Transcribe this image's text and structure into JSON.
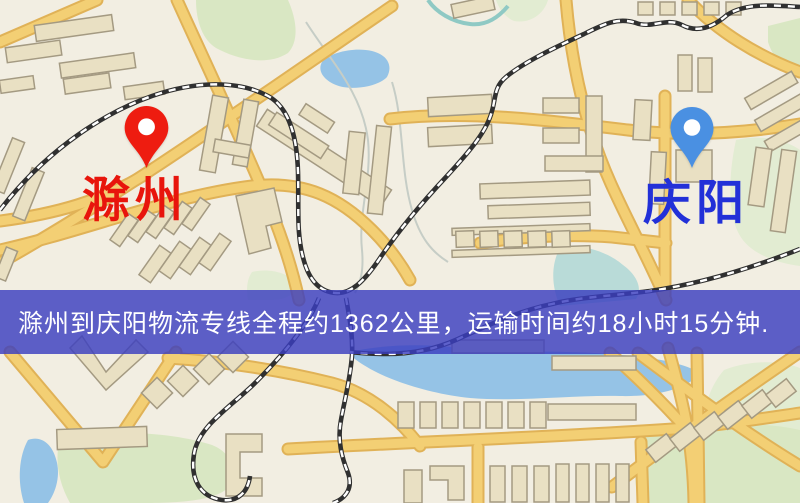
{
  "banner": {
    "text": "滁州到庆阳物流专线全程约1362公里，运输时间约18小时15分钟.",
    "background": "rgba(58,62,192,0.82)",
    "text_color": "#ffffff"
  },
  "markers": {
    "origin": {
      "label": "滁州",
      "pin_color": "#ee1c10",
      "label_color": "#e8150c"
    },
    "destination": {
      "label": "庆阳",
      "pin_color": "#4a90e2",
      "label_color": "#2230d8"
    }
  },
  "palette": {
    "base": "#f2eee2",
    "road": "#f3cf74",
    "road_casing": "#e0b257",
    "building": "#e9e0c3",
    "building_border": "#a49a82",
    "water": "#95c3e6",
    "park": "#d9e7c3",
    "railway": "#303030"
  }
}
